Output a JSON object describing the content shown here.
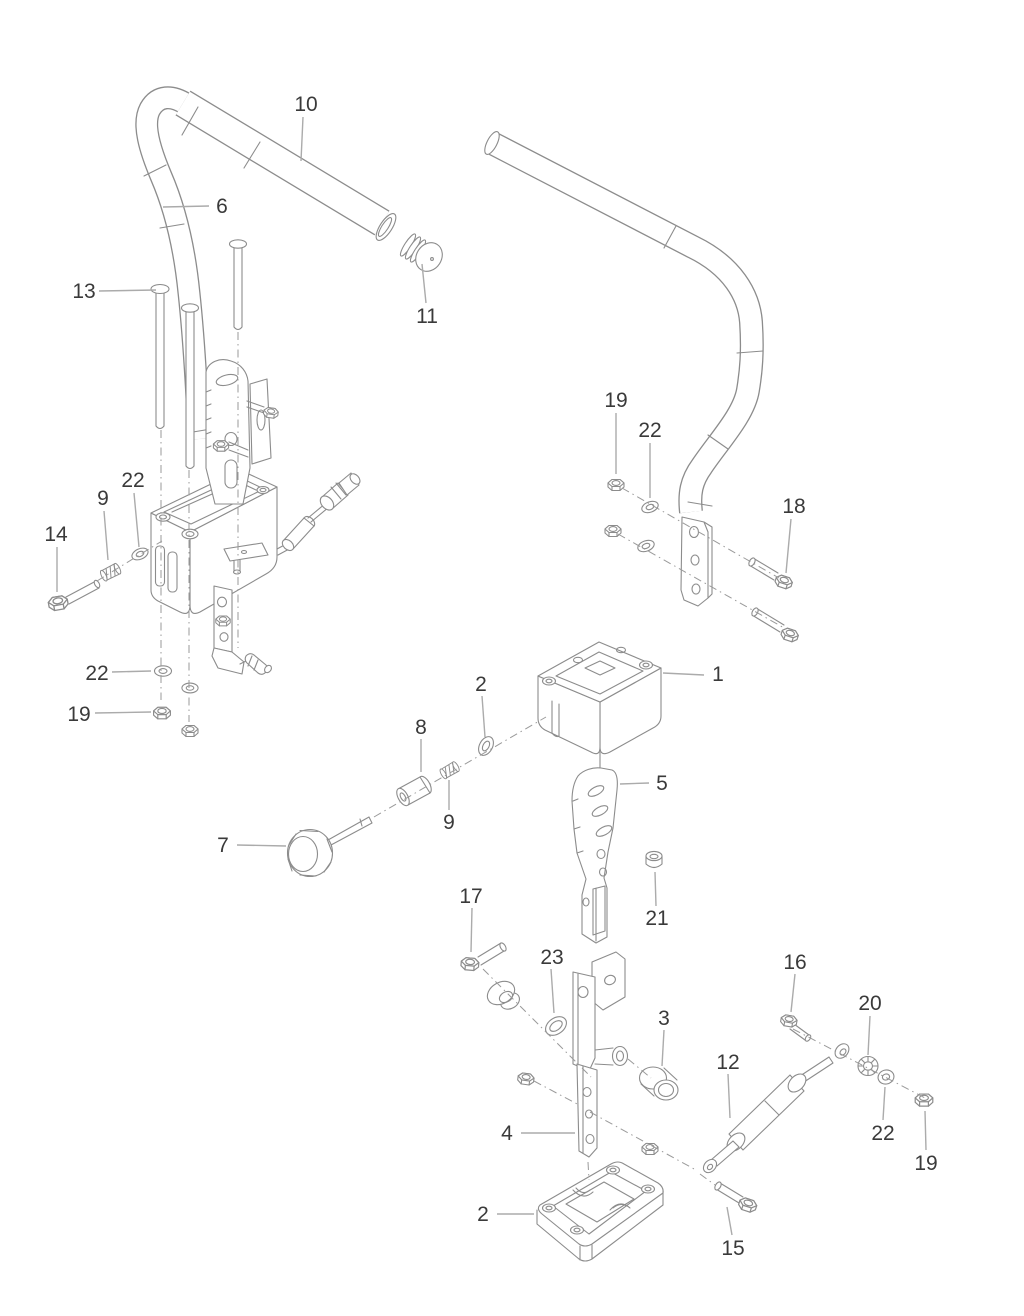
{
  "figure": {
    "type": "exploded-parts-diagram",
    "background": "#ffffff",
    "line_color": "#8c8c8c",
    "leader_color": "#ababab",
    "dash_color": "#9a9a9a",
    "label_color": "#3a3a3a",
    "part_numbers_shown": [
      "1",
      "2",
      "3",
      "4",
      "5",
      "6",
      "7",
      "8",
      "9",
      "10",
      "11",
      "12",
      "13",
      "14",
      "15",
      "16",
      "17",
      "18",
      "19",
      "20",
      "21",
      "22",
      "23"
    ]
  },
  "callouts": [
    {
      "label": "10",
      "tx": 306,
      "ty": 104,
      "x1": 303,
      "y1": 117,
      "x2": 301,
      "y2": 161
    },
    {
      "label": "6",
      "tx": 222,
      "ty": 206,
      "x1": 209,
      "y1": 206,
      "x2": 163,
      "y2": 207
    },
    {
      "label": "13",
      "tx": 84,
      "ty": 291,
      "x1": 99,
      "y1": 291,
      "x2": 156,
      "y2": 290
    },
    {
      "label": "11",
      "tx": 427,
      "ty": 316,
      "x1": 426,
      "y1": 303,
      "x2": 422,
      "y2": 264
    },
    {
      "label": "19",
      "tx": 616,
      "ty": 400,
      "x1": 616,
      "y1": 413,
      "x2": 616,
      "y2": 474
    },
    {
      "label": "22",
      "tx": 650,
      "ty": 430,
      "x1": 650,
      "y1": 443,
      "x2": 650,
      "y2": 498
    },
    {
      "label": "18",
      "tx": 794,
      "ty": 506,
      "x1": 791,
      "y1": 519,
      "x2": 786,
      "y2": 573
    },
    {
      "label": "9",
      "tx": 103,
      "ty": 498,
      "x1": 104,
      "y1": 511,
      "x2": 108,
      "y2": 560
    },
    {
      "label": "22",
      "tx": 133,
      "ty": 480,
      "x1": 134,
      "y1": 493,
      "x2": 139,
      "y2": 547
    },
    {
      "label": "14",
      "tx": 56,
      "ty": 534,
      "x1": 57,
      "y1": 547,
      "x2": 57,
      "y2": 592
    },
    {
      "label": "22",
      "tx": 97,
      "ty": 673,
      "x1": 112,
      "y1": 672,
      "x2": 151,
      "y2": 671
    },
    {
      "label": "19",
      "tx": 79,
      "ty": 714,
      "x1": 95,
      "y1": 713,
      "x2": 151,
      "y2": 712
    },
    {
      "label": "1",
      "tx": 718,
      "ty": 674,
      "x1": 704,
      "y1": 675,
      "x2": 663,
      "y2": 673
    },
    {
      "label": "2",
      "tx": 481,
      "ty": 684,
      "x1": 482,
      "y1": 696,
      "x2": 485,
      "y2": 737
    },
    {
      "label": "8",
      "tx": 421,
      "ty": 727,
      "x1": 421,
      "y1": 739,
      "x2": 421,
      "y2": 772
    },
    {
      "label": "9",
      "tx": 449,
      "ty": 822,
      "x1": 449,
      "y1": 810,
      "x2": 449,
      "y2": 780
    },
    {
      "label": "5",
      "tx": 662,
      "ty": 783,
      "x1": 649,
      "y1": 783,
      "x2": 620,
      "y2": 784
    },
    {
      "label": "21",
      "tx": 657,
      "ty": 918,
      "x1": 656,
      "y1": 906,
      "x2": 655,
      "y2": 872
    },
    {
      "label": "7",
      "tx": 223,
      "ty": 845,
      "x1": 237,
      "y1": 845,
      "x2": 286,
      "y2": 846
    },
    {
      "label": "17",
      "tx": 471,
      "ty": 896,
      "x1": 472,
      "y1": 908,
      "x2": 471,
      "y2": 952
    },
    {
      "label": "23",
      "tx": 552,
      "ty": 957,
      "x1": 551,
      "y1": 969,
      "x2": 554,
      "y2": 1013
    },
    {
      "label": "3",
      "tx": 664,
      "ty": 1018,
      "x1": 664,
      "y1": 1030,
      "x2": 662,
      "y2": 1066
    },
    {
      "label": "4",
      "tx": 507,
      "ty": 1133,
      "x1": 521,
      "y1": 1133,
      "x2": 575,
      "y2": 1133
    },
    {
      "label": "2",
      "tx": 483,
      "ty": 1214,
      "x1": 497,
      "y1": 1214,
      "x2": 534,
      "y2": 1214
    },
    {
      "label": "12",
      "tx": 728,
      "ty": 1062,
      "x1": 728,
      "y1": 1074,
      "x2": 730,
      "y2": 1118
    },
    {
      "label": "16",
      "tx": 795,
      "ty": 962,
      "x1": 795,
      "y1": 974,
      "x2": 791,
      "y2": 1012
    },
    {
      "label": "20",
      "tx": 870,
      "ty": 1003,
      "x1": 870,
      "y1": 1016,
      "x2": 868,
      "y2": 1055
    },
    {
      "label": "22",
      "tx": 883,
      "ty": 1133,
      "x1": 883,
      "y1": 1120,
      "x2": 885,
      "y2": 1087
    },
    {
      "label": "19",
      "tx": 926,
      "ty": 1163,
      "x1": 926,
      "y1": 1150,
      "x2": 925,
      "y2": 1111
    },
    {
      "label": "15",
      "tx": 733,
      "ty": 1248,
      "x1": 732,
      "y1": 1235,
      "x2": 727,
      "y2": 1207
    }
  ]
}
